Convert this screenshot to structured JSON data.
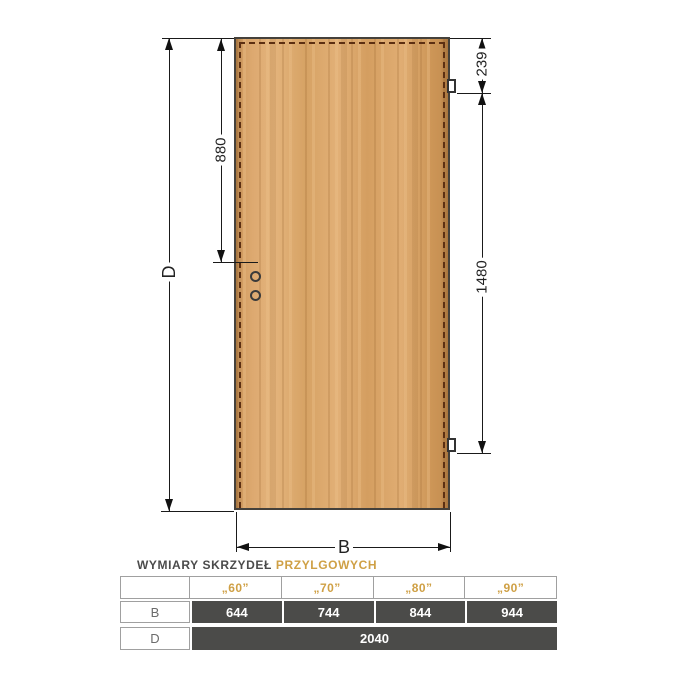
{
  "page": {
    "background": "#ffffff"
  },
  "diagram": {
    "dims": {
      "total_height": "D",
      "handle_from_top": "880",
      "hinge_from_top": "239",
      "hinge_spacing": "1480",
      "leaf_width": "B"
    },
    "colors": {
      "wood": "#d9a467",
      "line": "#1a1a1a",
      "rebate_dash": "#5c2f12",
      "hinge_fill": "#ffffff"
    }
  },
  "table": {
    "title_main": "WYMIARY SKRZYDEŁ",
    "title_accent": "PRZYLGOWYCH",
    "columns": [
      "„60”",
      "„70”",
      "„80”",
      "„90”"
    ],
    "rows": [
      {
        "label": "B",
        "values": [
          "644",
          "744",
          "844",
          "944"
        ]
      },
      {
        "label": "D",
        "values": [
          "2040"
        ]
      }
    ],
    "colors": {
      "accent_gold": "#cfa045",
      "cell_dark": "#4b4b49",
      "cell_text": "#ffffff",
      "grid_border": "#a0a0a0"
    }
  }
}
